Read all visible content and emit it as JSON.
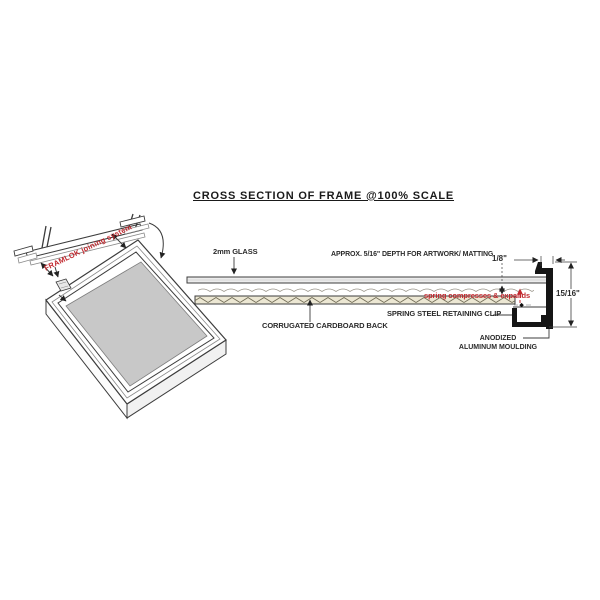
{
  "title": "CROSS SECTION OF FRAME @100% SCALE",
  "colors": {
    "accent_red": "#c1272d",
    "line_dark": "#3c3c3c",
    "moulding_black": "#151515",
    "cardboard_tan": "#ece7d3",
    "corrugation_brown": "#6f6a54",
    "matting_gray": "#c8c8c8",
    "glass_gray": "#ececec"
  },
  "perspective_view": {
    "joining_system_label": "FRAMLOK joining system"
  },
  "cross_section": {
    "glass_label": "2mm GLASS",
    "artwork_depth_label": "APPROX. 5/16\" DEPTH FOR ARTWORK/ MATTING",
    "cardboard_label": "CORRUGATED CARDBOARD BACK",
    "spring_note": "spring compresses & expands",
    "clip_label": "SPRING STEEL RETAINING CLIP",
    "moulding_label": [
      "ANODIZED",
      "ALUMINUM MOULDING"
    ],
    "dimensions": {
      "lip_width": "1/8\"",
      "moulding_height": "15/16\""
    }
  }
}
